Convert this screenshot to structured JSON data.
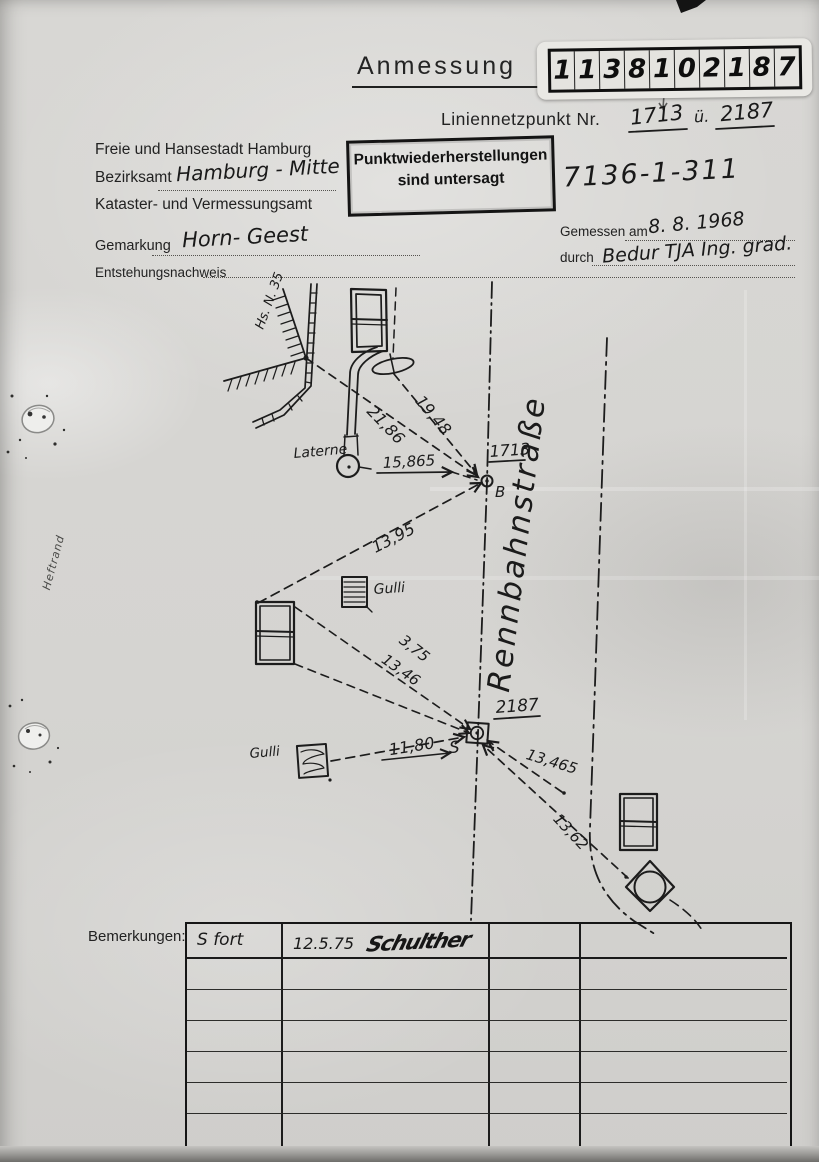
{
  "document": {
    "title": "Anmessung",
    "code_digits": [
      "1",
      "1",
      "3",
      "8",
      "1",
      "0",
      "2",
      "1",
      "8",
      "7"
    ],
    "line_point_label": "Liniennetzpunkt Nr.",
    "line_point_1": "1713",
    "line_point_sep": "ü.",
    "line_point_2": "2187",
    "file_number": "7136-1-311"
  },
  "office": {
    "city": "Freie und Hansestadt Hamburg",
    "district_label": "Bezirksamt",
    "district_value": "Hamburg - Mitte",
    "department": "Kataster- und Vermessungsamt",
    "gemarkung_label": "Gemarkung",
    "gemarkung_value": "Horn- Geest",
    "origin_label": "Entstehungsnachweis"
  },
  "stamp": {
    "line1": "Punktwiederherstellungen",
    "line2": "sind untersagt"
  },
  "survey": {
    "measured_label": "Gemessen am",
    "measured_date": "8. 8. 1968",
    "by_label": "durch",
    "by_value": "Bedur  TJA  Ing. grad."
  },
  "sketch": {
    "street_name": "Rennbahnstraße",
    "house_label": "Hs. N. 35",
    "lantern_label": "Laterne",
    "gulli_top_label": "Gulli",
    "gulli_left_label": "Gulli",
    "point_b_number": "1713",
    "point_b_letter": "B",
    "point_s_number": "2187",
    "point_s_letter": "S",
    "m_21_86": "21,86",
    "m_19_48": "19,48",
    "m_15_865": "15,865",
    "m_13_95": "13,95",
    "m_3_75": "3,75",
    "m_13_46": "13,46",
    "m_11_80": "11,80",
    "m_13_465": "13,465",
    "m_13_62": "13,62"
  },
  "margin_label": "Heftrand",
  "remarks": {
    "label": "Bemerkungen:",
    "row1": {
      "col1": "S fort",
      "date": "12.5.75",
      "signature": "Schulther"
    }
  },
  "colors": {
    "paper": "#d5d4d1",
    "ink": "#1c1c1c"
  }
}
